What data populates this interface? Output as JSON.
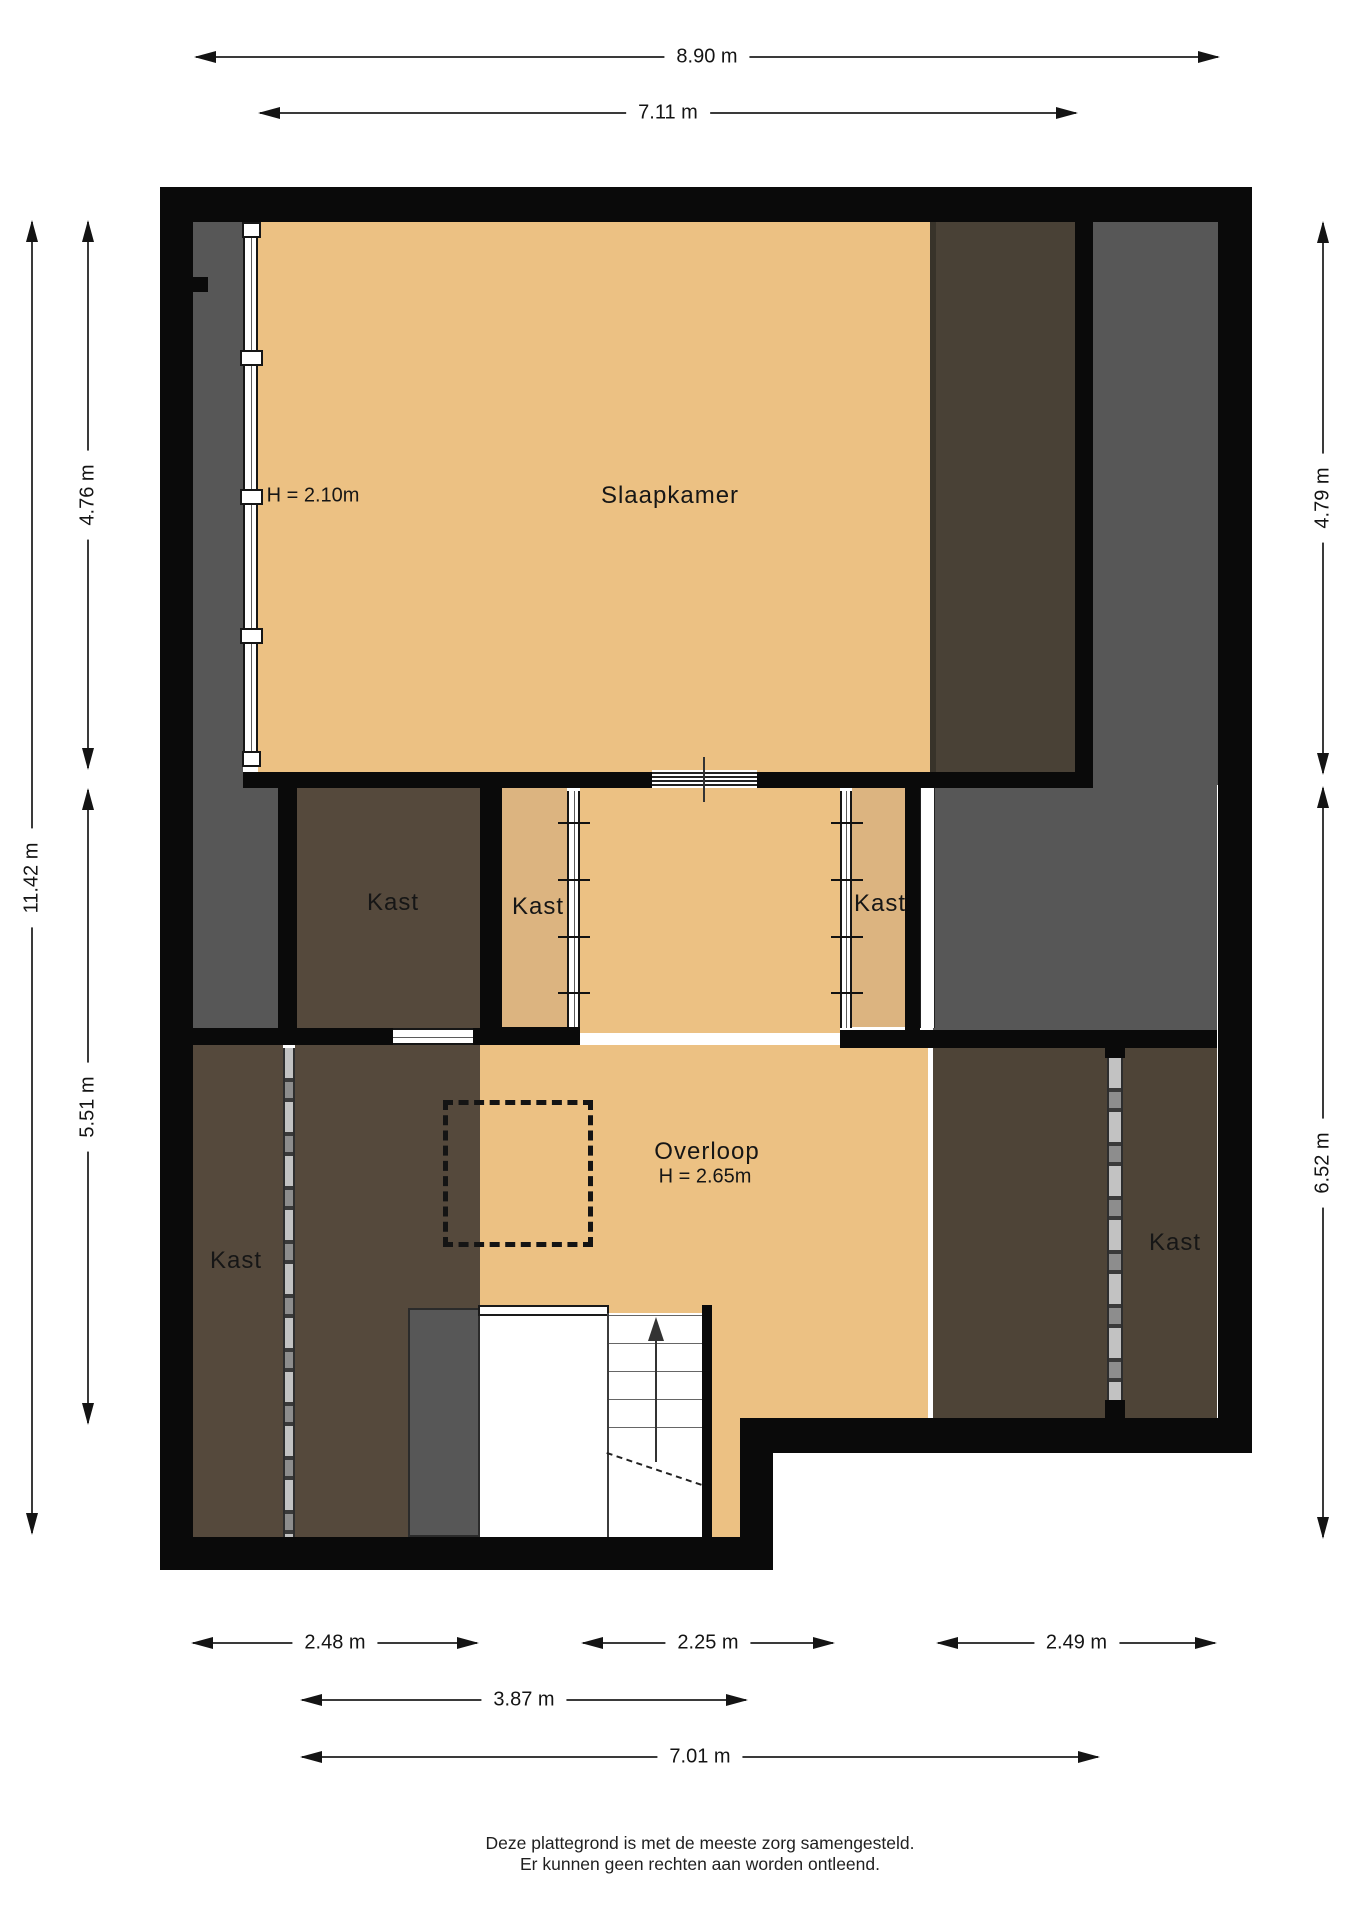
{
  "labels": {
    "slaapkamer": "Slaapkamer",
    "slaapkamer_height": "H = 2.10m",
    "overloop": "Overloop",
    "overloop_height": "H = 2.65m",
    "kasts": [
      "Kast",
      "Kast",
      "Kast",
      "Kast",
      "Kast"
    ]
  },
  "dimensions": {
    "top_total": "8.90 m",
    "top_inner": "7.11 m",
    "left_upper": "4.76 m",
    "left_total": "11.42 m",
    "left_lower": "5.51 m",
    "right_upper": "4.79 m",
    "right_lower": "6.52 m",
    "bottom_left": "2.48 m",
    "bottom_center": "2.25 m",
    "bottom_right": "2.49 m",
    "bottom_mid_row": "3.87 m",
    "bottom_total": "7.01 m"
  },
  "footer": {
    "line1": "Deze plattegrond is met de meeste zorg samengesteld.",
    "line2": "Er kunnen geen rechten aan worden ontleend."
  },
  "colors": {
    "wall": "#0a0a0a",
    "floor_orange": "#ecc183",
    "floor_tan": "#dcb480",
    "zone_gray": "#575757",
    "zone_brown_dark": "#494136",
    "room_brown": "#55493c",
    "room_brown_right": "#4e4437"
  }
}
